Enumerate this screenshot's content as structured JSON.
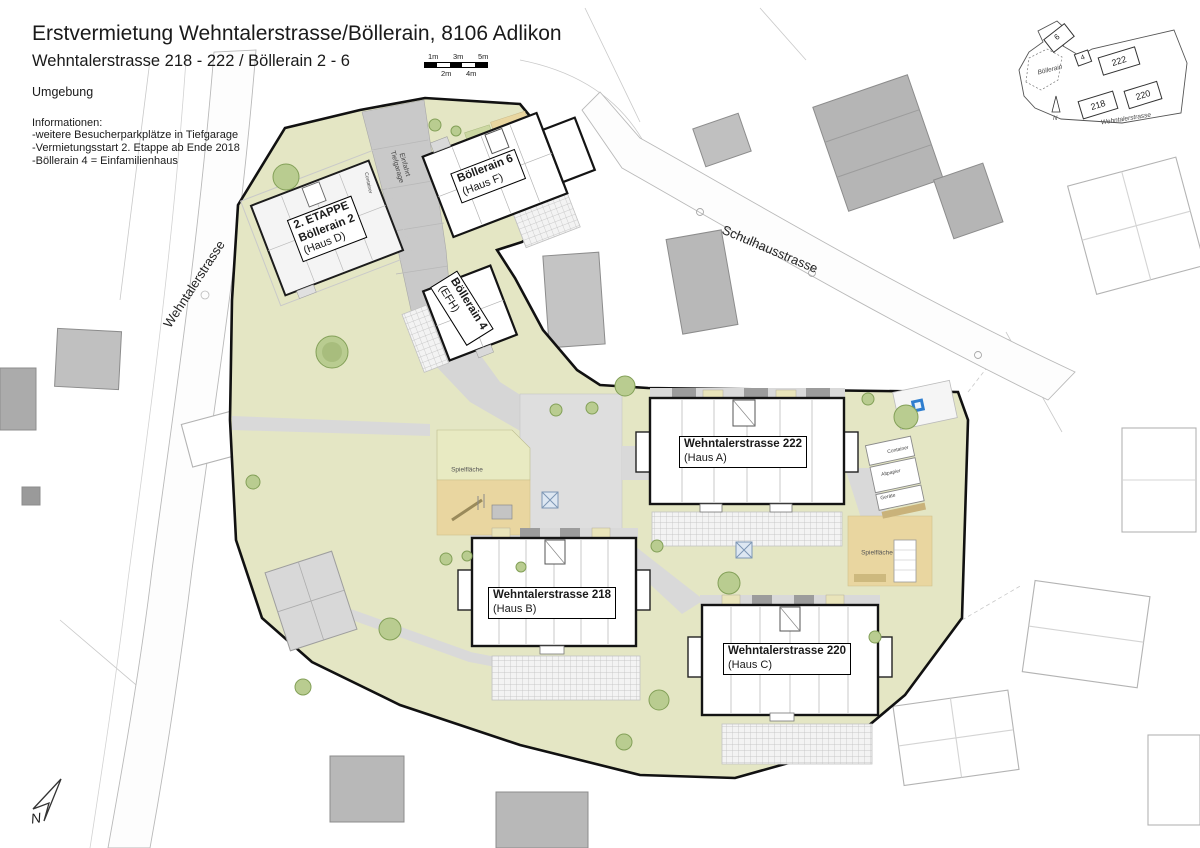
{
  "header": {
    "title": "Erstvermietung Wehntalerstrasse/Böllerain, 8106 Adlikon",
    "subtitle": "Wehntalerstrasse 218 - 222 / Böllerain 2 - 6",
    "section": "Umgebung",
    "info_heading": "Informationen:",
    "info_lines": [
      "-weitere Besucherparkplätze in Tiefgarage",
      "-Vermietungsstart 2. Etappe ab Ende 2018",
      "-Böllerain 4 = Einfamilienhaus"
    ]
  },
  "scalebar": {
    "labels_top": [
      "1m",
      "3m",
      "5m"
    ],
    "labels_bottom": [
      "2m",
      "4m"
    ]
  },
  "streets": {
    "wehntalerstrasse": "Wehntalerstrasse",
    "schulhausstrasse": "Schulhausstrasse",
    "ramp_line1": "Einfahrt",
    "ramp_line2": "Tiefgarage"
  },
  "buildings": {
    "haus_a": {
      "name": "Wehntalerstrasse 222",
      "unit": "(Haus A)"
    },
    "haus_b": {
      "name": "Wehntalerstrasse 218",
      "unit": "(Haus B)"
    },
    "haus_c": {
      "name": "Wehntalerstrasse 220",
      "unit": "(Haus C)"
    },
    "haus_d": {
      "stage": "2. ETAPPE",
      "name": "Böllerain 2",
      "unit": "(Haus D)"
    },
    "haus_f": {
      "name": "Böllerain 6",
      "unit": "(Haus F)"
    },
    "haus_efh": {
      "name": "Böllerain 4",
      "unit": "(EFH)"
    }
  },
  "site": {
    "playground_left": "Spielfläche",
    "playground_right": "Spielfläche",
    "shed_container": "Container",
    "shed_altpapier": "Altpapier",
    "shed_geraete": "Geräte",
    "container_etappe": "Container"
  },
  "minimap": {
    "b6": "6",
    "b4": "4",
    "b222": "222",
    "b218": "218",
    "b220": "220",
    "street_boellerain": "Böllerain",
    "street_wehntalerstrasse": "Wehntalerstrasse",
    "north": "N"
  },
  "compass": {
    "north": "N"
  },
  "colors": {
    "site_green": "#e4e6c4",
    "sand": "#e9d6a0",
    "marker_blue": "#2e7ecf",
    "outline": "#111111"
  }
}
